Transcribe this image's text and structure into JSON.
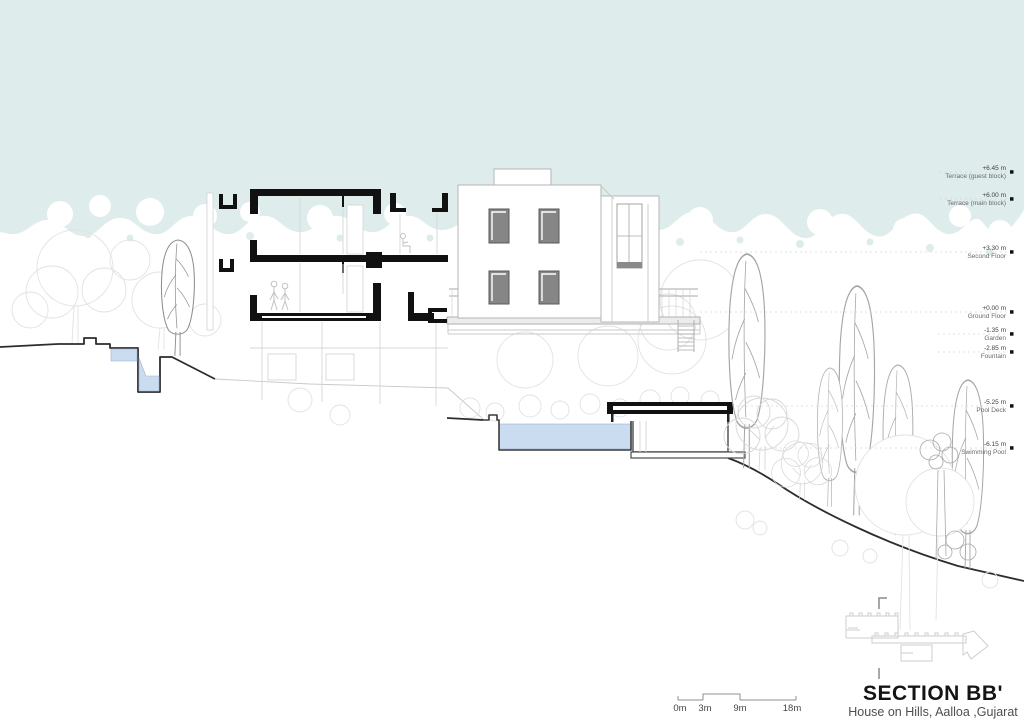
{
  "drawing": {
    "title": "SECTION BB'",
    "subtitle": "House on Hills, Aalloa ,Gujarat"
  },
  "levels": [
    {
      "value": "+6.45 m",
      "label": "Terrace (guest block)"
    },
    {
      "value": "+6.00 m",
      "label": "Terrace (main block)"
    },
    {
      "value": "+3.30 m",
      "label": "Second Floor"
    },
    {
      "value": "+0.00 m",
      "label": "Ground Floor"
    },
    {
      "value": "-1.35 m",
      "label": "Garden"
    },
    {
      "value": "-2.85 m",
      "label": "Fountain"
    },
    {
      "value": "-5.25 m",
      "label": "Pool Deck"
    },
    {
      "value": "-6.15 m",
      "label": "Swimming Pool"
    }
  ],
  "scale_bar": {
    "labels": [
      "0m",
      "3m",
      "9m",
      "18m"
    ]
  },
  "colors": {
    "sky": "#deedeb",
    "water": "#cadcf0",
    "poche": "#111111"
  }
}
